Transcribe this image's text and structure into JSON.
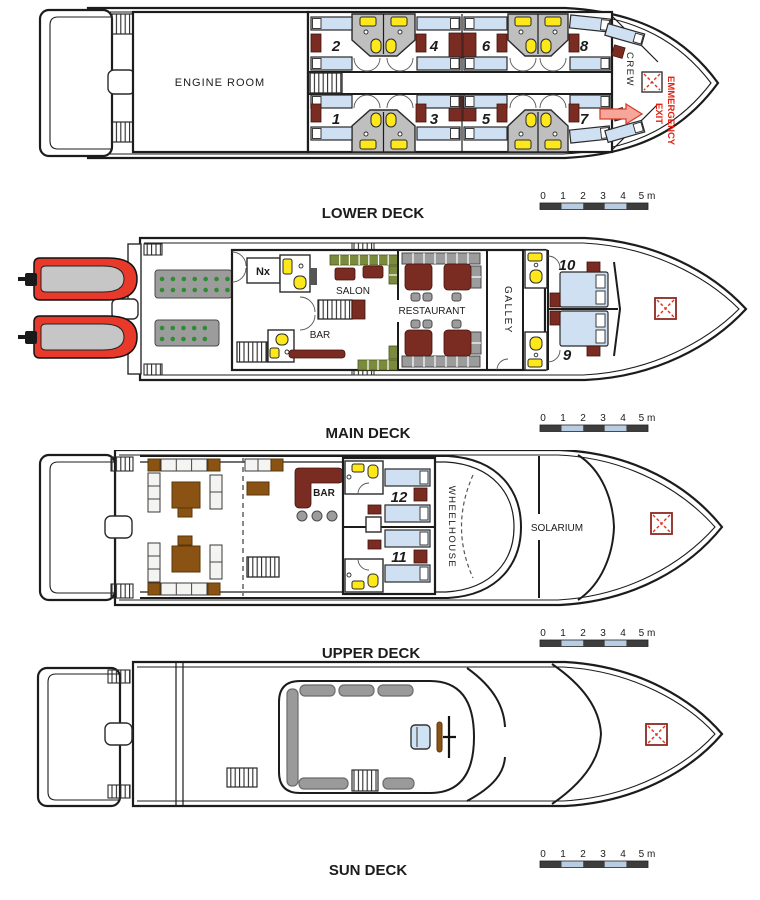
{
  "scale": {
    "ticks": [
      "0",
      "1",
      "2",
      "3",
      "4",
      "5 m"
    ]
  },
  "decks": {
    "lower": {
      "title": "LOWER DECK",
      "engine_room": "ENGINE ROOM",
      "crew": "CREW",
      "emergency": {
        "line1": "EMMERGENCY",
        "line2": "EXIT"
      },
      "cabins": [
        "1",
        "2",
        "3",
        "4",
        "5",
        "6",
        "7",
        "8"
      ]
    },
    "main": {
      "title": "MAIN DECK",
      "nx": "Nx",
      "salon": "SALON",
      "bar": "BAR",
      "restaurant": "RESTAURANT",
      "galley": "GALLEY",
      "cabins": [
        "9",
        "10"
      ]
    },
    "upper": {
      "title": "UPPER DECK",
      "bar": "BAR",
      "wheelhouse": "WHEELHOUSE",
      "solarium": "SOLARIUM",
      "cabins": [
        "11",
        "12"
      ]
    },
    "sun": {
      "title": "SUN DECK"
    }
  },
  "colors": {
    "accent_red": "#e02213",
    "bed_blue": "#cfe0f2",
    "furniture_dark_red": "#7a2b22",
    "fixture_yellow": "#ffe81a",
    "sofa_green": "#7b8b3d",
    "table_brown": "#8a5313",
    "tender_red": "#e8392a",
    "scale_dark": "#3d3d3d",
    "scale_light": "#b9cde2"
  }
}
